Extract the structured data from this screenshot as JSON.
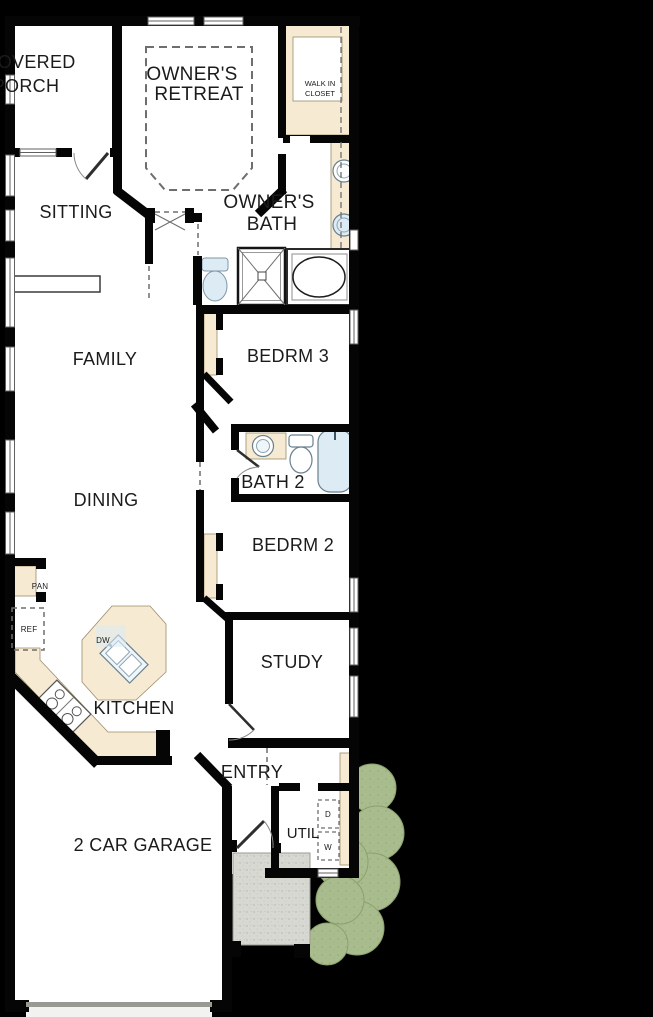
{
  "plan": {
    "type": "residential-floor-plan",
    "colors": {
      "background": "#000000",
      "floor": "#ffffff",
      "wall": "#050505",
      "cabinetry": "#f6ead2",
      "fixture_blue": "#dcebf4",
      "porch_concrete": "#d8d8d2",
      "landscape_green": "#a9bc8d",
      "dash_gray": "#777777",
      "text": "#1b1b1b"
    },
    "rooms": {
      "covered_porch": {
        "line1": "COVERED",
        "line2": "PORCH"
      },
      "owners_retreat": {
        "line1": "OWNER'S",
        "line2": "RETREAT"
      },
      "walk_in_closet": {
        "line1": "WALK IN",
        "line2": "CLOSET"
      },
      "sitting": {
        "label": "SITTING"
      },
      "owners_bath": {
        "line1": "OWNER'S",
        "line2": "BATH"
      },
      "family": {
        "label": "FAMILY"
      },
      "bedroom3": {
        "label": "BEDRM 3"
      },
      "bath2": {
        "label": "BATH 2"
      },
      "dining": {
        "label": "DINING"
      },
      "bedroom2": {
        "label": "BEDRM 2"
      },
      "kitchen": {
        "label": "KITCHEN"
      },
      "study": {
        "label": "STUDY"
      },
      "entry": {
        "label": "ENTRY"
      },
      "utility": {
        "label": "UTIL"
      },
      "garage": {
        "label": "2 CAR GARAGE"
      }
    },
    "fixtures": {
      "pantry": "PAN",
      "refrigerator": "REF",
      "dishwasher": "DW",
      "dryer": "D",
      "washer": "W"
    }
  }
}
